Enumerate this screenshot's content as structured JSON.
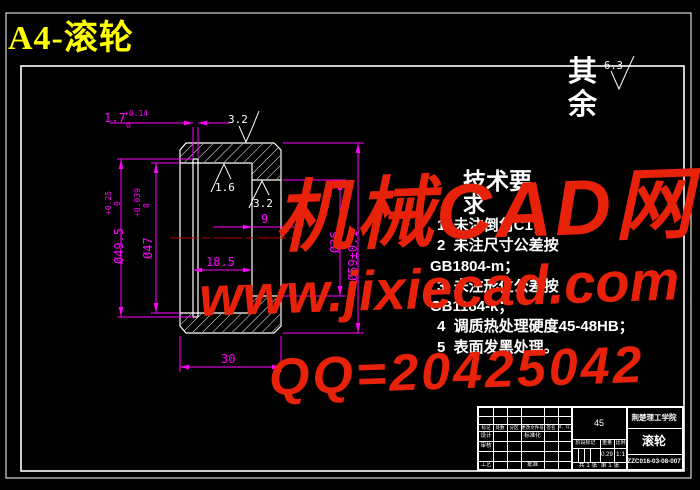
{
  "page": {
    "title": "A4-滚轮",
    "background": "#000000"
  },
  "surface_note": {
    "label": "其余",
    "roughness": "6.3"
  },
  "watermark": {
    "line1": "机械CAD网",
    "line2": "www.jixiecad.com",
    "line3": "QQ=20425042",
    "color": "#e8220a"
  },
  "tech_req": {
    "heading_line1": "技术要",
    "heading_line2": "求",
    "lines": [
      "1  未注倒角C1；",
      "2  未注尺寸公差按",
      "GB1804-m；",
      "3  未注形位公差按",
      "GB1184-k；",
      "4  调质热处理硬度45-48HB；",
      "5  表面发黑处理。"
    ]
  },
  "dims": {
    "overall_width": "30",
    "bore_depth": "18.5",
    "recess_depth": "9",
    "groove_width": "1.7",
    "groove_width_tol_upper": "+0.14",
    "groove_width_tol_lower": "0",
    "groove_dia": "Ø49.5",
    "groove_dia_tol_upper": "+0.25",
    "groove_dia_tol_lower": "0",
    "bore_dia": "Ø47",
    "bore_dia_tol_upper": "+0.039",
    "bore_dia_tol_lower": "0",
    "recess_dia": "Ø36",
    "outer_dia": "Ø59±0.1",
    "roughness_top": "3.2",
    "roughness_bore": "1.6",
    "roughness_recess": "3.2",
    "dim_color": "#ff00ff",
    "centerline_color": "#bb0000"
  },
  "title_block": {
    "material": "45",
    "company": "荆楚理工学院",
    "part_name": "滚轮",
    "drawing_no": "ZZC016-03-08-007",
    "headers": {
      "mark": "标记",
      "count": "处数",
      "zone": "分区",
      "change_file": "更改文件号",
      "signature": "签名",
      "date": "年、月、日"
    },
    "labels": {
      "design": "设计",
      "standardization": "标准化",
      "check": "审核",
      "process": "工艺",
      "approve": "批准"
    },
    "stage_mark_label": "阶段标记",
    "weight_label": "重量",
    "scale_label": "比例",
    "weight": "0.29",
    "scale": "1:1",
    "sheet_info": "共 1 张  第 1 张"
  }
}
